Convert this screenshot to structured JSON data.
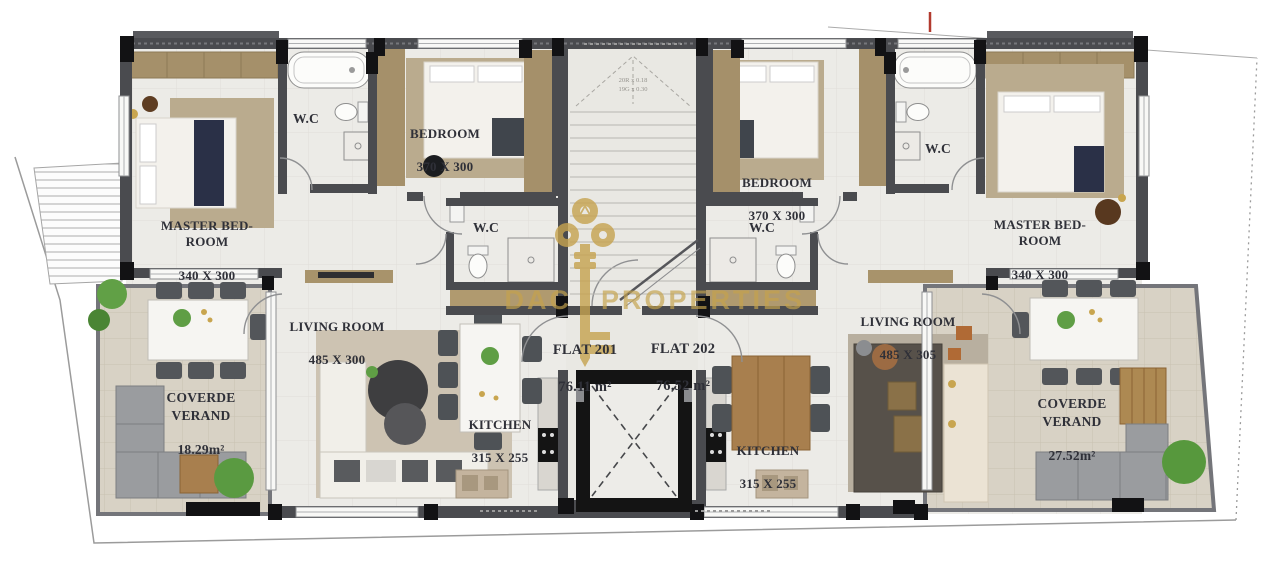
{
  "watermark": {
    "brand_left": "DAC",
    "brand_right": "PROPERTIES",
    "color": "#c6a34f"
  },
  "stairwell": {
    "note": "20R x 0.18\n19G x 0.30"
  },
  "flats": [
    {
      "label": "FLAT 201",
      "area": "76.11 m²"
    },
    {
      "label": "FLAT 202",
      "area": "76.52 m²"
    }
  ],
  "rooms": {
    "master_left": {
      "label": "MASTER BED-\nROOM",
      "dims": "340 X 300"
    },
    "wc_bath_left": {
      "label": "W.C"
    },
    "bedroom_left": {
      "label": "BEDROOM",
      "dims": "370 X 300"
    },
    "wc_hall_left": {
      "label": "W.C"
    },
    "living_left": {
      "label": "LIVING ROOM",
      "dims": "485 X 300"
    },
    "kitchen_left": {
      "label": "KITCHEN",
      "dims": "315 X 255"
    },
    "veranda_left": {
      "label": "COVERDE\nVERAND",
      "area": "18.29m²"
    },
    "bedroom_right": {
      "label": "BEDROOM",
      "dims": "370 X 300"
    },
    "wc_hall_right": {
      "label": "W.C"
    },
    "wc_bath_right": {
      "label": "W.C"
    },
    "master_right": {
      "label": "MASTER BED-\nROOM",
      "dims": "340 X 300"
    },
    "living_right": {
      "label": "LIVING ROOM",
      "dims": "485 X 305"
    },
    "kitchen_right": {
      "label": "KITCHEN",
      "dims": "315 X 255"
    },
    "veranda_right": {
      "label": "COVERDE\nVERAND",
      "area": "27.52m²"
    }
  },
  "palette": {
    "wall": "#4a4b4f",
    "column": "#121214",
    "floor": "#ecebe7",
    "veranda_floor": "#d8d2c5",
    "wood": "#a87f4e",
    "closet": "#a5906a",
    "rug": "#baab8e",
    "navy": "#2a3047",
    "plant": "#5f9e45",
    "gold": "#c6a34f"
  }
}
